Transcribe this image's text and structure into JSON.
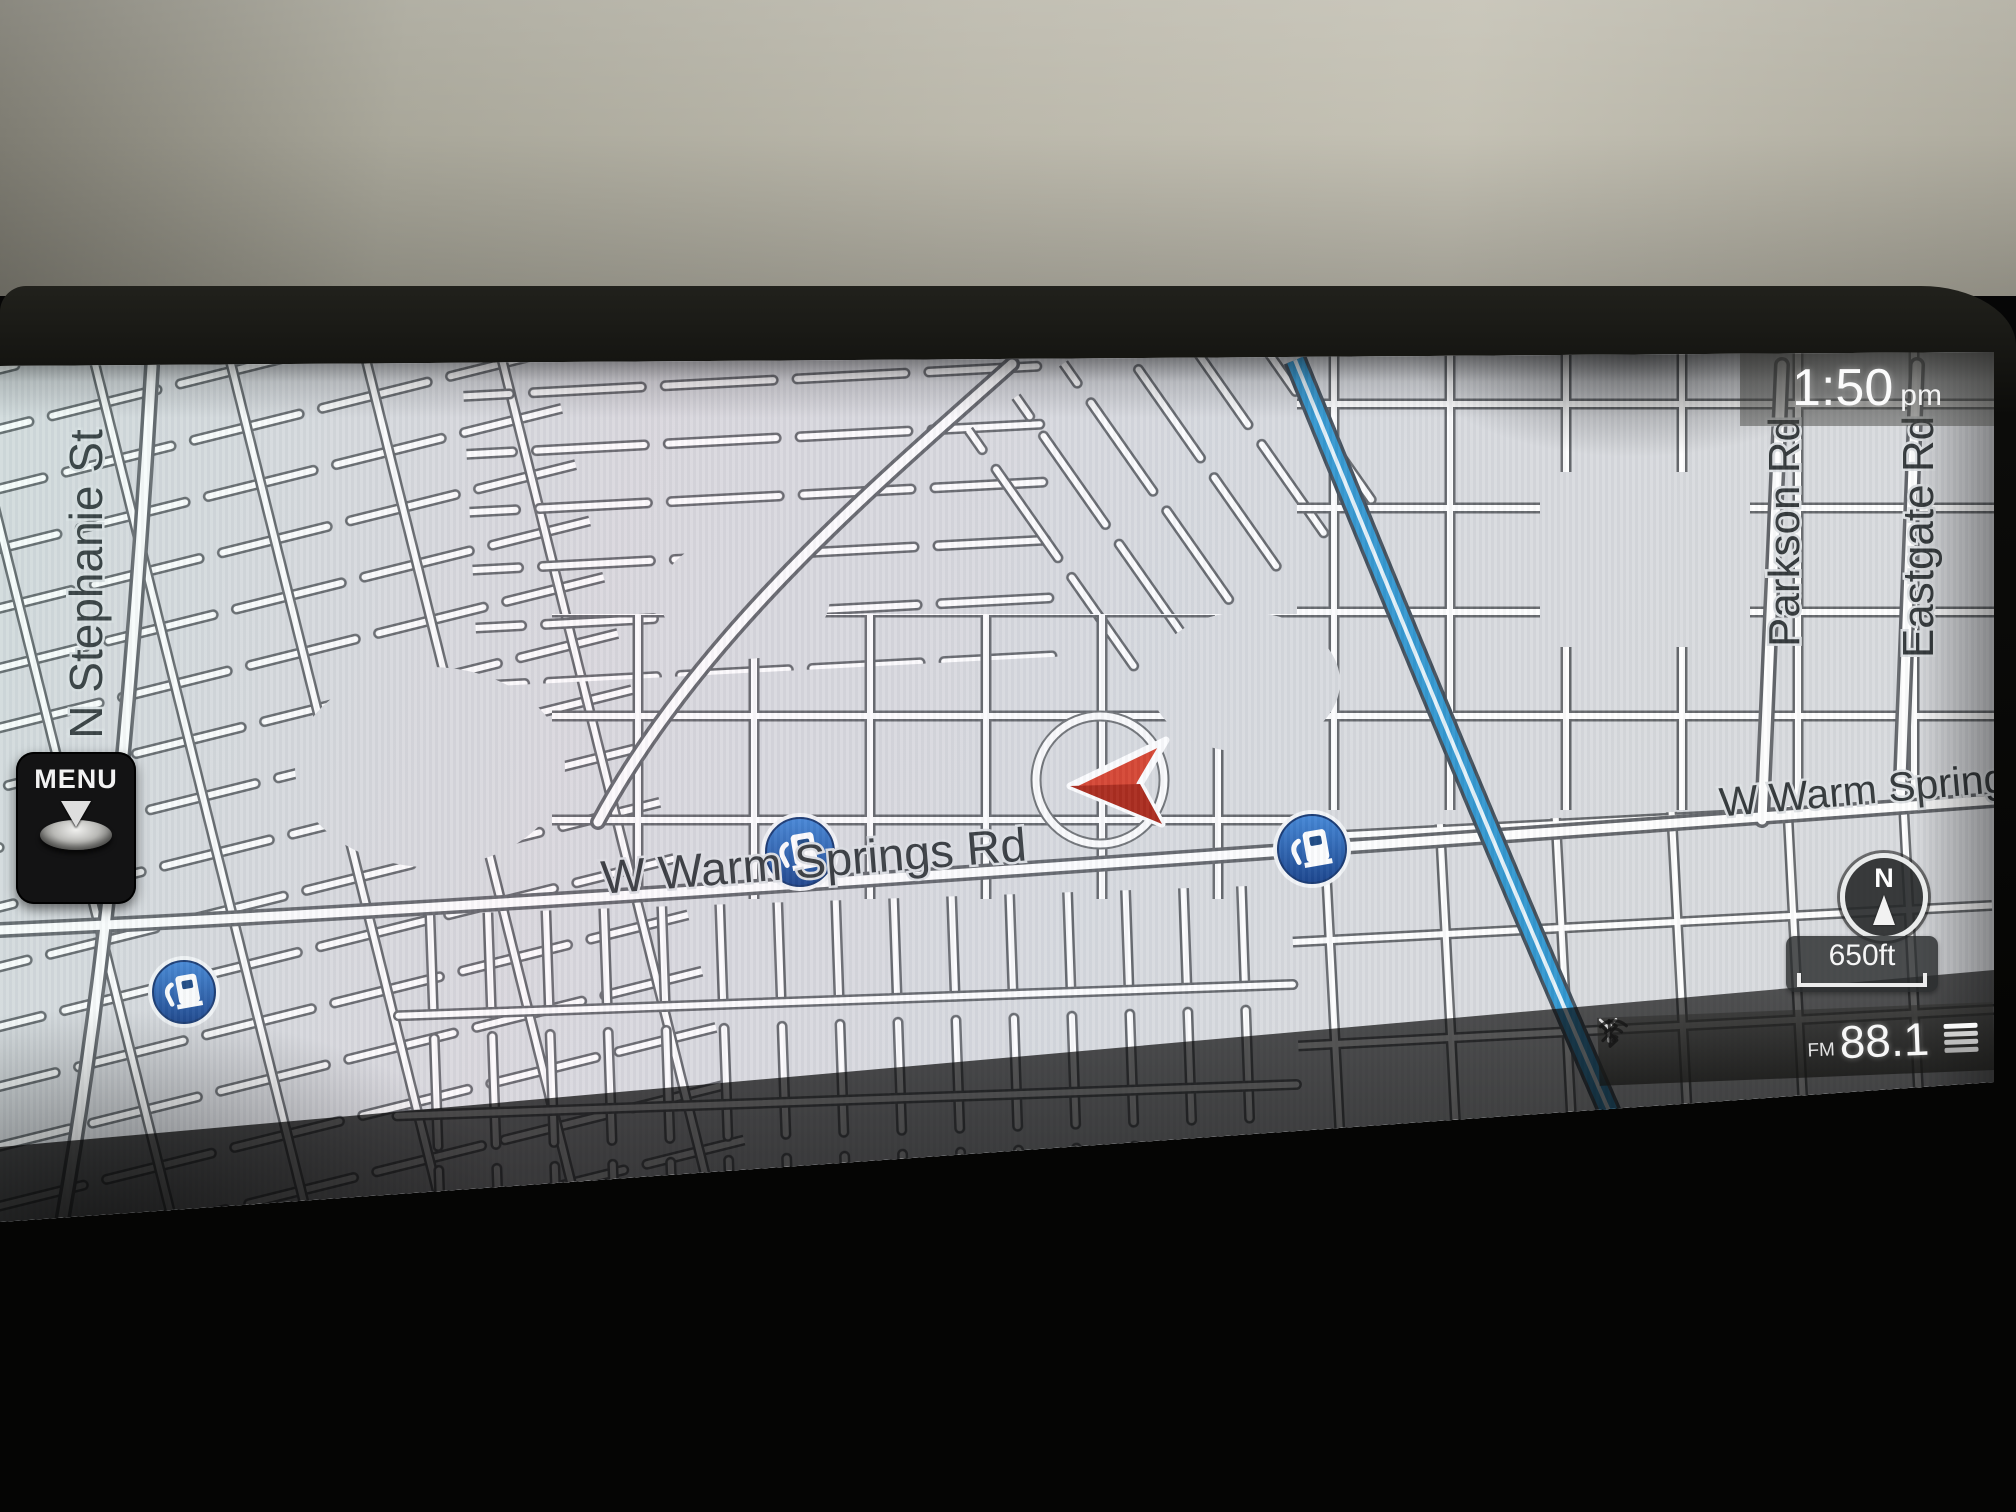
{
  "device": {
    "name": "car-navigation-display"
  },
  "time": {
    "value": "1:50",
    "meridiem": "pm"
  },
  "menu": {
    "label": "MENU"
  },
  "map": {
    "street_labels": [
      {
        "text": "N Stephanie St"
      },
      {
        "text": "W Warm Springs Rd"
      },
      {
        "text": "W Warm Spring"
      },
      {
        "text": "Parkson Rd"
      },
      {
        "text": "Eastgate Rd"
      }
    ],
    "compass": {
      "label": "N"
    },
    "scale": {
      "label": "650ft"
    },
    "poi_gas_station_count": 3
  },
  "status_bar": {
    "band": "FM",
    "frequency": "88.1",
    "icons": [
      "antenna-icon",
      "bluetooth-icon",
      "wifi-icon",
      "signal-bars-icon"
    ]
  },
  "colors": {
    "freeway_blue": "#2a94cf",
    "gas_poi_blue": "#1b5ab2",
    "vehicle_arrow_red": "#d63a24",
    "map_background": "#d8dade",
    "wall_beige": "#b8b5a8"
  }
}
